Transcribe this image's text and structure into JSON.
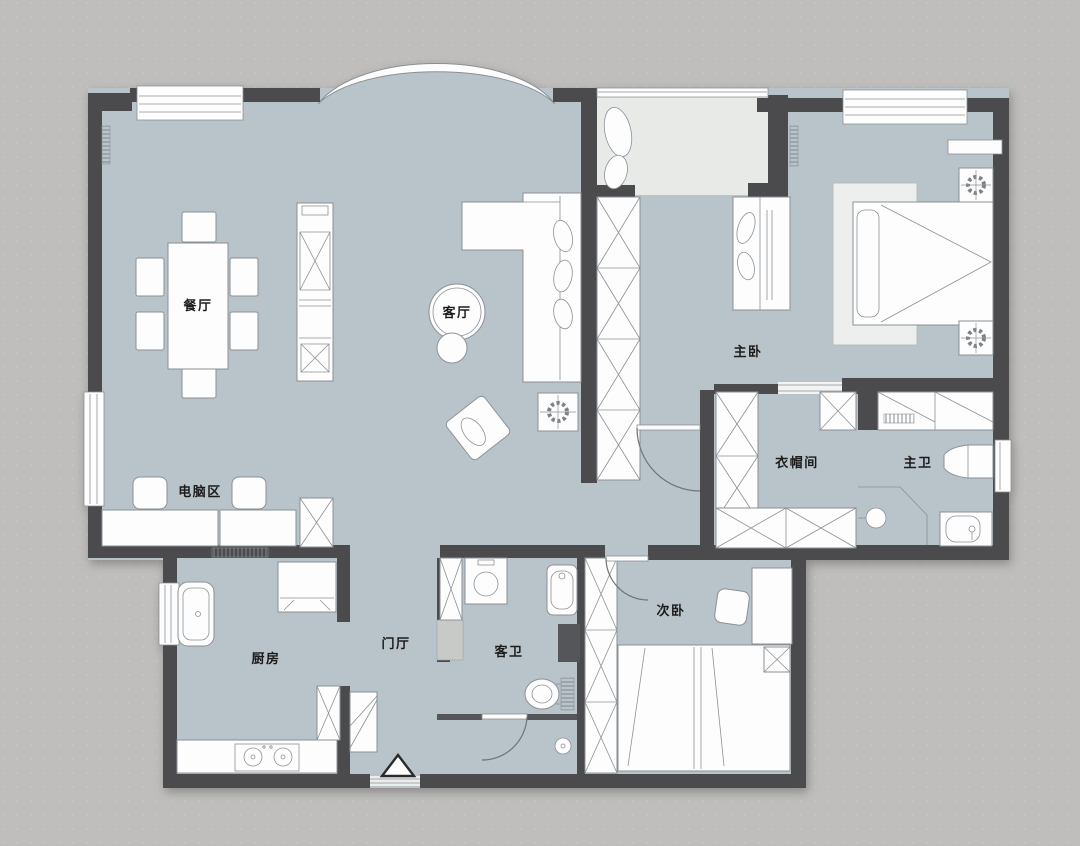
{
  "plan": {
    "type": "floor-plan",
    "rooms": {
      "dining": {
        "label": "餐厅"
      },
      "living": {
        "label": "客厅"
      },
      "master_bedroom": {
        "label": "主卧"
      },
      "cloakroom": {
        "label": "衣帽间"
      },
      "master_bath": {
        "label": "主卫"
      },
      "computer_area": {
        "label": "电脑区"
      },
      "kitchen": {
        "label": "厨房"
      },
      "foyer": {
        "label": "门厅"
      },
      "guest_bath": {
        "label": "客卫"
      },
      "second_bedroom": {
        "label": "次卧"
      }
    },
    "colors": {
      "background": "#bfbebc",
      "floor": "#b8c3ca",
      "balcony_floor": "#e8eae8",
      "wall": "#4b4c4e",
      "furniture": "#fdfdfd",
      "furniture_stroke": "#8b9196",
      "label": "#1c1c1c"
    }
  }
}
